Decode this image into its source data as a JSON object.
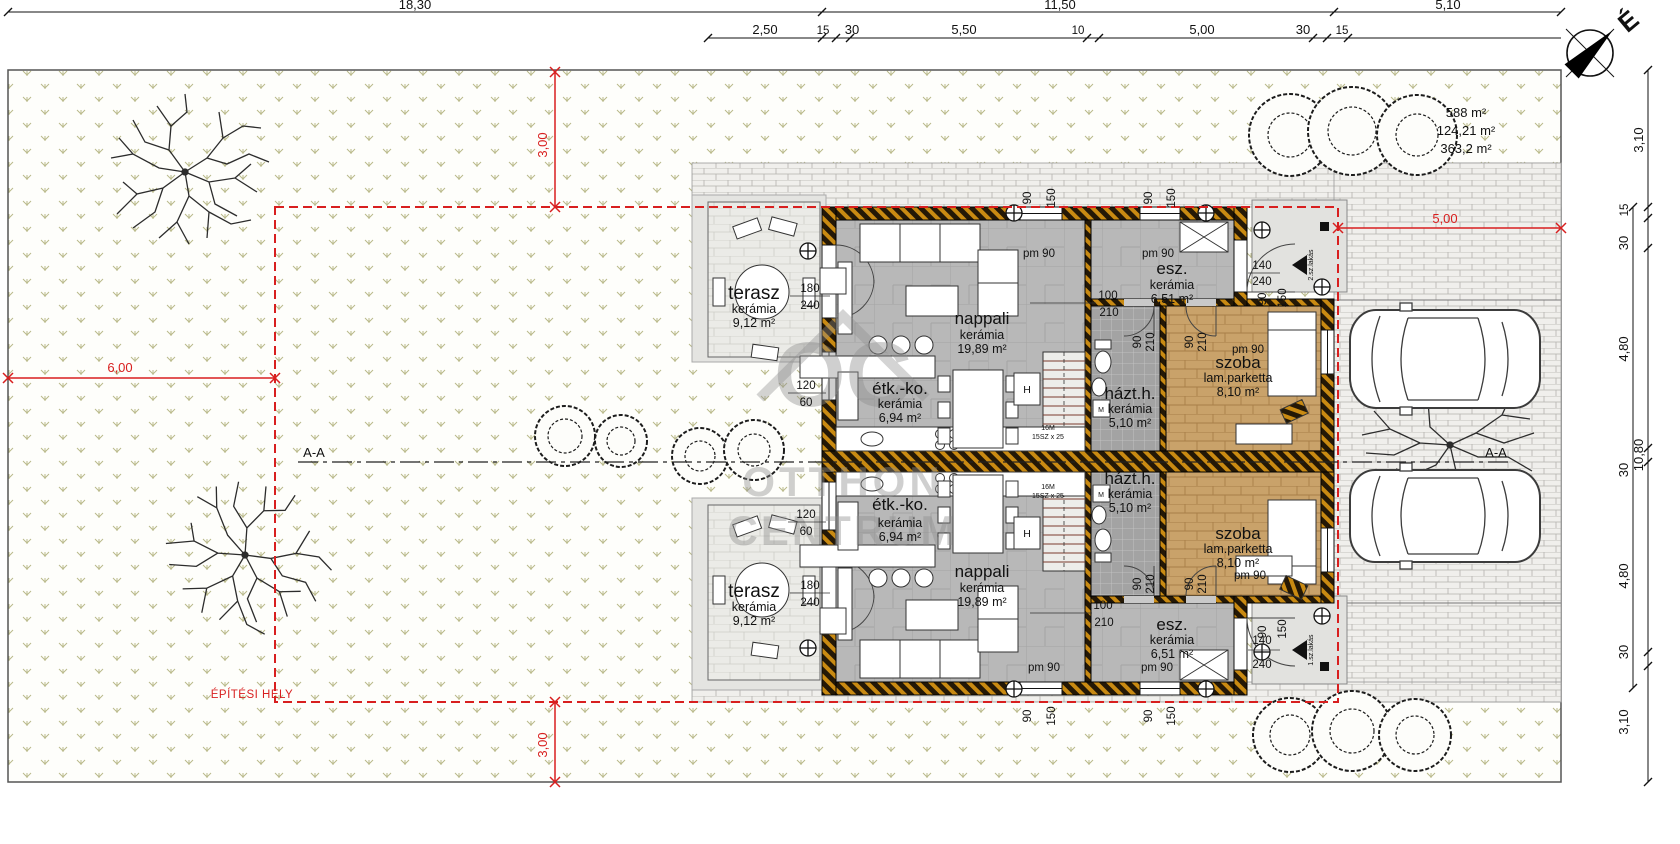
{
  "dims": {
    "top_row": [
      "18,30",
      "11,50",
      "5,10"
    ],
    "top_row2": [
      "2,50",
      "15",
      "30",
      "5,50",
      "10",
      "5,00",
      "30",
      "15"
    ],
    "right_col": [
      "3,10",
      "15",
      "30",
      "4,80",
      "30",
      "4,80",
      "30",
      "3,10"
    ],
    "right_overall": "10,80",
    "red_top": "3,00",
    "red_left": "6,00",
    "red_right": "5,00",
    "red_bottom": "3,00"
  },
  "site": {
    "areas": [
      "588 m²",
      "124,21 m²",
      "363,2 m²"
    ],
    "building_site_label": "ÉPÍTÉSI HELY",
    "section": "A-A",
    "north": "É"
  },
  "rooms": {
    "terasz": {
      "name": "terasz",
      "floor": "kerámia",
      "area": "9,12 m²"
    },
    "nappali": {
      "name": "nappali",
      "floor": "kerámia",
      "area": "19,89 m²"
    },
    "etkko": {
      "name": "étk.-ko.",
      "floor": "kerámia",
      "area": "6,94 m²"
    },
    "esz": {
      "name": "esz.",
      "floor": "kerámia",
      "area": "6,51 m²"
    },
    "hazth": {
      "name": "házt.h.",
      "floor": "kerámia",
      "area": "5,10 m²"
    },
    "szoba": {
      "name": "szoba",
      "floor": "lam.parketta",
      "area": "8,10 m²"
    }
  },
  "openings": {
    "terrace_door": [
      "180",
      "240"
    ],
    "kitchen_window": [
      "120",
      "60"
    ],
    "hall_door": [
      "100",
      "210"
    ],
    "room_door": [
      "90",
      "210"
    ],
    "entry_door": [
      "140",
      "240"
    ],
    "window": [
      "90",
      "150"
    ],
    "sill": "pm 90"
  },
  "stairs": {
    "l1": "16M",
    "l2": "15SZ x 25"
  },
  "appliances": {
    "fridge": "H",
    "washer": "M"
  },
  "apartments": {
    "a1": "1.sz.lakás",
    "a2": "2.sz.lakás"
  },
  "watermark": {
    "initials": "OC",
    "l1": "OTTHON",
    "l2": "CENTRUM"
  }
}
